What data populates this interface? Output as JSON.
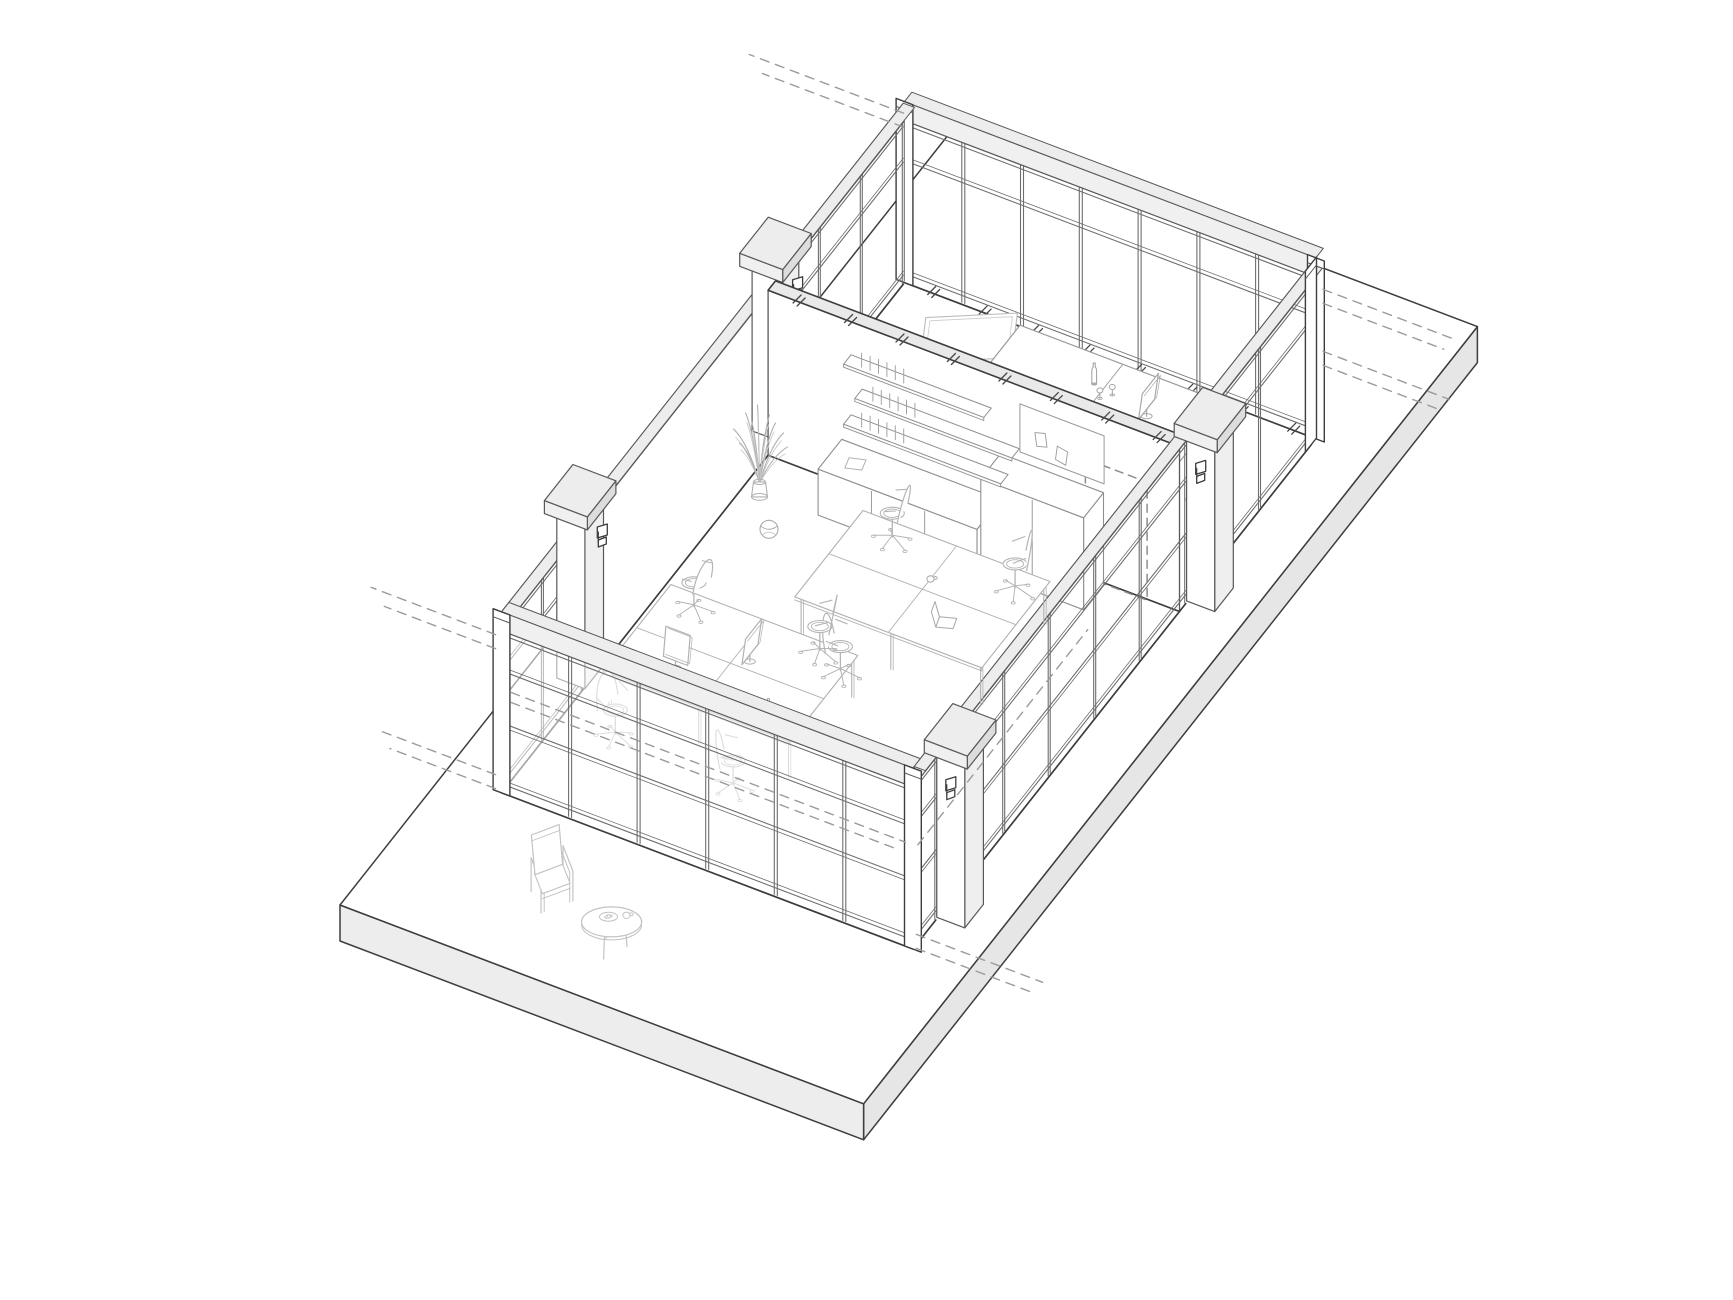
{
  "meta": {
    "title": "Axonometric cutaway line drawing of an office floor with glazed partition walls, meeting room, open-plan desks and lounge corner",
    "canvas": {
      "w": 1733,
      "h": 1300
    }
  },
  "colors": {
    "bg": "#ffffff",
    "line_dark": "#3d3d3d",
    "line_arch": "#585858",
    "line_glaz": "#6e6e6e",
    "line_soft": "#9a9a9a",
    "furn": "#a9a9a9",
    "furn_light": "#c3c3c3",
    "dash": "#9b9b9b",
    "tick": "#474747",
    "fill_white": "#ffffff",
    "fill_band": "#f0f0f0",
    "fill_cap_top": "#ededed",
    "fill_cap_side": "#dddddd",
    "fill_slab_sw": "#ededed",
    "fill_slab_se": "#e6e6e6",
    "fill_shaft": "#f8f8f8",
    "fill_shaft_side": "#efefef",
    "glass_fade": "rgba(255,255,255,0.55)"
  },
  "projection": {
    "origin": [
      340,
      905
    ],
    "a": [
      0.935,
      0.355
    ],
    "b": [
      0.62,
      -0.785
    ]
  },
  "slab": {
    "da": 560,
    "db": 990,
    "th": 36
  },
  "walls": {
    "height": 165,
    "band_top": 181,
    "transom": 122,
    "sill": 9,
    "spandrel": 70,
    "glazed": [
      {
        "name": "northeast-glazed-wall",
        "axis": "a",
        "at": 820,
        "from": 60,
        "to": 500,
        "bays": 7,
        "post_from": true,
        "post_to": true,
        "base_ticks": true
      },
      {
        "name": "northwest-glazed-upper",
        "axis": "b",
        "at": 60,
        "from": 615,
        "to": 818,
        "bays": 3
      },
      {
        "name": "northwest-glazed-lower",
        "axis": "b",
        "at": 60,
        "from": 172,
        "to": 300,
        "bays": 2
      },
      {
        "name": "southeast-glazed-upper",
        "axis": "b",
        "at": 500,
        "from": 646,
        "to": 812,
        "bays": 2,
        "post_to": true
      },
      {
        "name": "southeast-glazed-mid",
        "axis": "b",
        "at": 500,
        "from": 243,
        "to": 610,
        "bays": 5,
        "spandrel": true
      },
      {
        "name": "southeast-glazed-low",
        "axis": "b",
        "at": 500,
        "from": 172,
        "to": 207,
        "bays": 1,
        "spandrel": true
      },
      {
        "name": "southwest-glazed-wall",
        "axis": "a",
        "at": 170,
        "from": 60,
        "to": 500,
        "bays": 6,
        "post_from": true,
        "post_to": true,
        "overlay": true,
        "spandrel": true
      }
    ],
    "solid": [
      {
        "name": "northwest-solid-wall",
        "axis": "b",
        "at": 60,
        "from": 300,
        "to": 615
      }
    ],
    "interior_shelf_wall": {
      "name": "interior-shelf-wall",
      "at_b": 600,
      "from_a": 60,
      "to_a": 500,
      "th": 12,
      "top_ticks": true,
      "door": {
        "from_a": 400,
        "to_a": 466,
        "h": 118
      }
    }
  },
  "columns": [
    {
      "name": "column-northwest-low",
      "a": 46,
      "b": 318,
      "fixture": "a"
    },
    {
      "name": "column-northwest-high",
      "a": 46,
      "b": 633,
      "fixture": "a"
    },
    {
      "name": "column-southeast-high",
      "a": 514,
      "b": 628,
      "fixture": "b"
    },
    {
      "name": "column-southeast-low",
      "a": 514,
      "b": 225,
      "fixture": "b"
    }
  ],
  "dashed_refs": [
    {
      "from": [
        55,
        826,
        163
      ],
      "to": [
        -110,
        826,
        163
      ]
    },
    {
      "from": [
        55,
        826,
        149
      ],
      "to": [
        -96,
        826,
        149
      ]
    },
    {
      "from": [
        505,
        824,
        148
      ],
      "to": [
        648,
        824,
        148
      ]
    },
    {
      "from": [
        505,
        824,
        134
      ],
      "to": [
        634,
        824,
        134
      ]
    },
    {
      "from": [
        505,
        824,
        86
      ],
      "to": [
        640,
        824,
        86
      ]
    },
    {
      "from": [
        505,
        824,
        72
      ],
      "to": [
        626,
        824,
        72
      ]
    },
    {
      "from": [
        55,
        168,
        158
      ],
      "to": [
        -78,
        168,
        158
      ]
    },
    {
      "from": [
        55,
        168,
        144
      ],
      "to": [
        -64,
        168,
        144
      ]
    },
    {
      "from": [
        55,
        168,
        18
      ],
      "to": [
        -70,
        168,
        18
      ]
    },
    {
      "from": [
        55,
        168,
        4
      ],
      "to": [
        -58,
        168,
        4
      ]
    },
    {
      "from": [
        505,
        168,
        18
      ],
      "to": [
        640,
        168,
        18
      ]
    },
    {
      "from": [
        505,
        168,
        4
      ],
      "to": [
        626,
        168,
        4
      ]
    },
    {
      "from": [
        70,
        170,
        104
      ],
      "to": [
        492,
        170,
        104
      ]
    },
    {
      "from": [
        70,
        170,
        94
      ],
      "to": [
        480,
        170,
        94
      ]
    },
    {
      "from": [
        500,
        178,
        98
      ],
      "to": [
        500,
        452,
        98
      ]
    }
  ],
  "furniture": {
    "meeting_room": {
      "table": {
        "a0": 210,
        "b0": 700,
        "da": 220,
        "db": 80,
        "h": 42,
        "seam_a": 320
      },
      "monitor": {
        "pos": [
          372,
          740
        ],
        "face": "a"
      },
      "bottle": {
        "pos": [
          308,
          752
        ]
      },
      "glasses": [
        [
          322,
          740
        ],
        [
          330,
          748
        ]
      ],
      "whiteboard": {
        "pos": [
          150,
          788
        ],
        "rot": 28,
        "w": 82,
        "d": 52
      },
      "side_chair": {
        "pos": [
          118,
          732
        ],
        "rot": 95
      },
      "office_chairs": [
        {
          "pos": [
            168,
            682
          ],
          "rot": 35
        },
        {
          "pos": [
            452,
            712
          ],
          "rot": 250
        }
      ]
    },
    "open_office": {
      "bench_1": {
        "a0": 200,
        "b0": 432,
        "da": 200,
        "db": 110,
        "h": 40,
        "seam_a": 300,
        "seam_b": 487
      },
      "bench_2": {
        "a0": 90,
        "b0": 288,
        "da": 200,
        "db": 110,
        "h": 40,
        "seam_a": 190,
        "seam_b": 343
      },
      "office_chairs": [
        {
          "pos": [
            218,
            562
          ],
          "rot": 190
        },
        {
          "pos": [
            352,
            558
          ],
          "rot": 215
        },
        {
          "pos": [
            262,
            412
          ],
          "rot": 15
        },
        {
          "pos": [
            100,
            420
          ],
          "rot": 170
        },
        {
          "pos": [
            232,
            424
          ],
          "rot": 205
        },
        {
          "pos": [
            118,
            266
          ],
          "rot": 345
        },
        {
          "pos": [
            248,
            260
          ],
          "rot": 25
        }
      ],
      "laptop": {
        "pos": [
          342,
          462
        ],
        "rot": 18
      },
      "cup": {
        "pos": [
          300,
          500
        ]
      },
      "monitors": [
        {
          "pos": [
            205,
            352
          ],
          "face": "a"
        },
        {
          "pos": [
            148,
            318
          ],
          "face": "b"
        }
      ],
      "bottle": {
        "pos": [
          258,
          302
        ]
      }
    },
    "lounge": {
      "armchair": {
        "pos": [
          168,
          88
        ],
        "rot": -38
      },
      "coffee_table": {
        "pos": [
          252,
          58
        ]
      }
    },
    "plant": {
      "pos": [
        80,
        556
      ]
    },
    "ball": {
      "pos": [
        114,
        520
      ]
    },
    "shelving": {
      "credenza": {
        "a0": 140,
        "b0": 560,
        "da": 170,
        "db": 38,
        "h": 46,
        "seams": [
          197,
          254
        ]
      },
      "tall_cabinet": {
        "a0": 310,
        "b0": 566,
        "da": 110,
        "db": 32,
        "h": 92,
        "seam": 365
      },
      "planks": [
        {
          "a0": 150,
          "a1": 318,
          "h": 74
        },
        {
          "a0": 162,
          "a1": 330,
          "h": 104
        },
        {
          "a0": 150,
          "a1": 300,
          "h": 134
        }
      ],
      "pinboard": {
        "a0": 330,
        "a1": 420,
        "h0": 100,
        "h1": 148
      },
      "paper_on_top": {
        "pos": [
          168,
          578
        ],
        "rot": 15
      }
    }
  }
}
